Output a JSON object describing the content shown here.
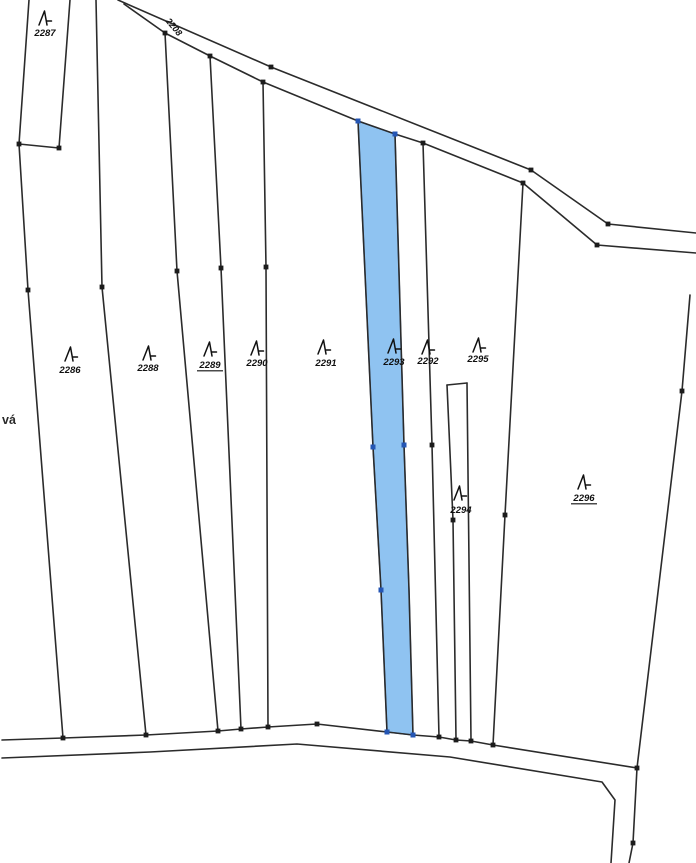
{
  "map": {
    "title": "cadastral-parcel-map",
    "background": "#ffffff",
    "colors": {
      "line": "#2b2b2b",
      "dot": "#1c1c1c",
      "label": "#101010",
      "highlight_fill": "#8fc3f1",
      "highlight_stroke": "#2f62b5",
      "highlight_dot": "#2456b4"
    },
    "highlighted_parcel": {
      "id": "2293",
      "points": [
        [
          358,
          121
        ],
        [
          395,
          134
        ],
        [
          404,
          445
        ],
        [
          409,
          590
        ],
        [
          413,
          735
        ],
        [
          387,
          732
        ],
        [
          381,
          590
        ],
        [
          373,
          447
        ]
      ]
    },
    "boundary_lines": [
      {
        "name": "road-top-upper-edge",
        "points": [
          [
            118,
            0
          ],
          [
            271,
            67
          ],
          [
            531,
            170
          ],
          [
            608,
            224
          ],
          [
            696,
            233
          ]
        ]
      },
      {
        "name": "road-top-lower-edge",
        "points": [
          [
            124,
            4
          ],
          [
            165,
            33
          ],
          [
            210,
            56
          ],
          [
            263,
            82
          ],
          [
            358,
            121
          ],
          [
            395,
            134
          ],
          [
            423,
            143
          ],
          [
            523,
            183
          ],
          [
            597,
            245
          ],
          [
            696,
            253
          ]
        ]
      },
      {
        "name": "parcel-2287-left-boundary",
        "points": [
          [
            29,
            0
          ],
          [
            19,
            144
          ]
        ]
      },
      {
        "name": "parcel-2287-bottom-boundary",
        "points": [
          [
            19,
            144
          ],
          [
            59,
            148
          ]
        ]
      },
      {
        "name": "parcel-2287-right-boundary",
        "points": [
          [
            70,
            0
          ],
          [
            59,
            148
          ]
        ]
      },
      {
        "name": "parcel-2286-left-boundary",
        "points": [
          [
            19,
            144
          ],
          [
            28,
            290
          ],
          [
            63,
            738
          ]
        ]
      },
      {
        "name": "boundary-2286-2288",
        "points": [
          [
            96,
            0
          ],
          [
            102,
            287
          ],
          [
            146,
            735
          ]
        ]
      },
      {
        "name": "boundary-2288-2289",
        "points": [
          [
            165,
            33
          ],
          [
            177,
            271
          ],
          [
            218,
            731
          ]
        ]
      },
      {
        "name": "boundary-2289-2290",
        "points": [
          [
            210,
            56
          ],
          [
            221,
            268
          ],
          [
            241,
            729
          ]
        ]
      },
      {
        "name": "boundary-2290-2291",
        "points": [
          [
            263,
            82
          ],
          [
            266,
            267
          ],
          [
            268,
            727
          ]
        ]
      },
      {
        "name": "boundary-2291-2293",
        "points": [
          [
            358,
            121
          ],
          [
            373,
            447
          ],
          [
            381,
            590
          ],
          [
            387,
            732
          ]
        ]
      },
      {
        "name": "boundary-2293-2292",
        "points": [
          [
            395,
            134
          ],
          [
            404,
            445
          ],
          [
            409,
            590
          ],
          [
            413,
            735
          ]
        ]
      },
      {
        "name": "boundary-2292-2295",
        "points": [
          [
            423,
            143
          ],
          [
            432,
            445
          ],
          [
            439,
            737
          ]
        ]
      },
      {
        "name": "parcel-2294-top-boundary",
        "points": [
          [
            447,
            385
          ],
          [
            467,
            383
          ]
        ]
      },
      {
        "name": "parcel-2294-left-boundary",
        "points": [
          [
            447,
            385
          ],
          [
            453,
            520
          ],
          [
            456,
            739
          ]
        ]
      },
      {
        "name": "parcel-2294-right-boundary",
        "points": [
          [
            467,
            383
          ],
          [
            471,
            740
          ]
        ]
      },
      {
        "name": "boundary-2295-2296",
        "points": [
          [
            523,
            183
          ],
          [
            505,
            515
          ],
          [
            493,
            745
          ]
        ]
      },
      {
        "name": "parcel-2296-right-boundary",
        "points": [
          [
            690,
            295
          ],
          [
            682,
            391
          ],
          [
            637,
            768
          ],
          [
            633,
            843
          ],
          [
            629,
            863
          ]
        ]
      },
      {
        "name": "road-bottom-upper-edge",
        "points": [
          [
            2,
            740
          ],
          [
            63,
            738
          ],
          [
            146,
            735
          ],
          [
            218,
            731
          ],
          [
            241,
            729
          ],
          [
            268,
            727
          ],
          [
            317,
            724
          ],
          [
            387,
            732
          ],
          [
            413,
            735
          ],
          [
            439,
            737
          ],
          [
            456,
            740
          ],
          [
            471,
            741
          ],
          [
            493,
            745
          ],
          [
            637,
            768
          ]
        ]
      },
      {
        "name": "road-bottom-lower-edge",
        "points": [
          [
            2,
            758
          ],
          [
            150,
            752
          ],
          [
            297,
            744
          ],
          [
            450,
            757
          ],
          [
            602,
            782
          ],
          [
            615,
            800
          ],
          [
            611,
            863
          ]
        ]
      }
    ],
    "vertex_dots": [
      [
        19,
        144
      ],
      [
        59,
        148
      ],
      [
        28,
        290
      ],
      [
        102,
        287
      ],
      [
        165,
        33
      ],
      [
        210,
        56
      ],
      [
        263,
        82
      ],
      [
        271,
        67
      ],
      [
        177,
        271
      ],
      [
        221,
        268
      ],
      [
        266,
        267
      ],
      [
        63,
        738
      ],
      [
        146,
        735
      ],
      [
        218,
        731
      ],
      [
        241,
        729
      ],
      [
        268,
        727
      ],
      [
        317,
        724
      ],
      [
        423,
        143
      ],
      [
        432,
        445
      ],
      [
        439,
        737
      ],
      [
        453,
        520
      ],
      [
        456,
        740
      ],
      [
        471,
        741
      ],
      [
        493,
        745
      ],
      [
        523,
        183
      ],
      [
        531,
        170
      ],
      [
        608,
        224
      ],
      [
        597,
        245
      ],
      [
        505,
        515
      ],
      [
        682,
        391
      ],
      [
        637,
        768
      ],
      [
        633,
        843
      ]
    ],
    "highlight_dots": [
      [
        358,
        121
      ],
      [
        395,
        134
      ],
      [
        373,
        447
      ],
      [
        404,
        445
      ],
      [
        381,
        590
      ],
      [
        387,
        732
      ],
      [
        413,
        735
      ]
    ],
    "parcel_labels": [
      {
        "text": "2287",
        "x": 45,
        "y": 36,
        "underline": false,
        "sym": [
          37,
          10
        ]
      },
      {
        "text": "2286",
        "x": 70,
        "y": 373,
        "underline": false,
        "sym": [
          63,
          346
        ]
      },
      {
        "text": "2288",
        "x": 148,
        "y": 371,
        "underline": false,
        "sym": [
          141,
          345
        ]
      },
      {
        "text": "2289",
        "x": 210,
        "y": 368,
        "underline": true,
        "sym": [
          202,
          341
        ]
      },
      {
        "text": "2290",
        "x": 257,
        "y": 366,
        "underline": false,
        "sym": [
          249,
          340
        ]
      },
      {
        "text": "2291",
        "x": 326,
        "y": 366,
        "underline": false,
        "sym": [
          316,
          339
        ]
      },
      {
        "text": "2293",
        "x": 394,
        "y": 365,
        "underline": false,
        "sym": [
          386,
          338
        ]
      },
      {
        "text": "2292",
        "x": 428,
        "y": 364,
        "underline": false,
        "sym": [
          420,
          339
        ]
      },
      {
        "text": "2295",
        "x": 478,
        "y": 362,
        "underline": false,
        "sym": [
          471,
          337
        ]
      },
      {
        "text": "2294",
        "x": 461,
        "y": 513,
        "underline": false,
        "sym": [
          452,
          485
        ]
      },
      {
        "text": "2296",
        "x": 584,
        "y": 501,
        "underline": true,
        "sym": [
          576,
          474
        ]
      }
    ],
    "road_label": {
      "text": "2208",
      "x": 174,
      "y": 27,
      "rotation": 50
    },
    "edge_text_fragment": {
      "text": "vá",
      "x": 2,
      "y": 424
    }
  }
}
